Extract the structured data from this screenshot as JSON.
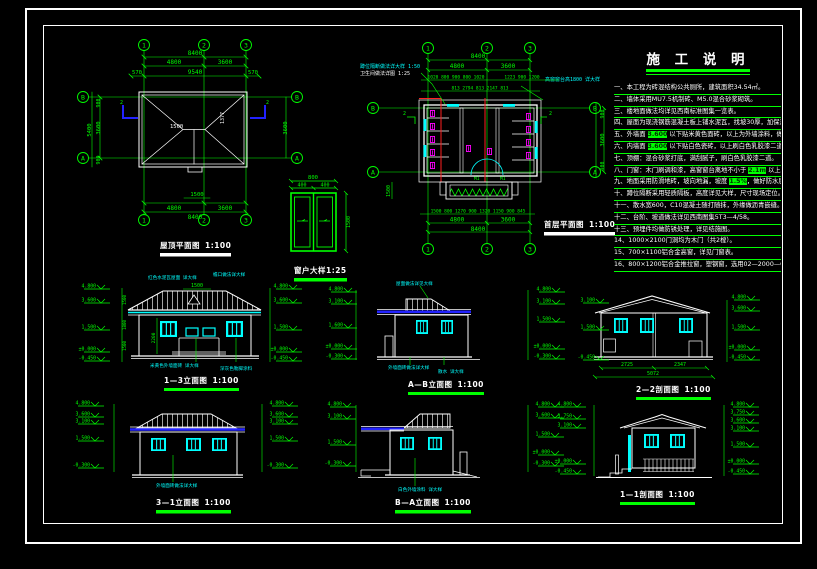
{
  "app": {
    "type": "architectural CAD sheet",
    "language": "zh-CN"
  },
  "colors": {
    "background": "#000000",
    "line_white": "#ffffff",
    "dim_green": "#00ff00",
    "window_cyan": "#00ffff",
    "fixture_magenta": "#ff00ff",
    "section_red": "#ff2020",
    "eave_blue": "#2222ff",
    "highlight_bg": "#00ff00"
  },
  "grid": {
    "c1": "1",
    "c2": "2",
    "c3": "3",
    "rB": "B",
    "rA": "A"
  },
  "roof_plan": {
    "title": "屋顶平面图",
    "scale": "1:100",
    "dim_total": "8400",
    "dim_seg1": "4800",
    "dim_seg2": "3600",
    "dim_oh_left": "570",
    "dim_oh_total": "9540",
    "dim_oh_right": "570",
    "dim_notch": "1500",
    "dim_left_total": "5400",
    "dim_left_seg": "3600",
    "dim_left_m1": "900",
    "dim_left_m2": "900",
    "dim_right_seg": "3600",
    "ridge_len": "1500",
    "slope_dim": "1377",
    "section_label": "2"
  },
  "window_detail": {
    "title": "窗户大样1:25",
    "dim_total": "800",
    "dim_half1": "400",
    "dim_half2": "400",
    "dim_height": "1500"
  },
  "floor_plan": {
    "title": "首层平面图",
    "scale": "1:100",
    "ann_left_1": "蹲位隔断做法详大样 1:50",
    "ann_left_2": "卫生间做法详图 1:25",
    "ann_right": "高窗窗台高1800 详大样",
    "dim_total": "8400",
    "dim_seg1": "4800",
    "dim_seg2": "3600",
    "dims_small_top_a": "1020 800 900 800 1020",
    "dims_small_top_b": "1223 900 1200",
    "dims_small_top2": "813 2794 813 2147 813",
    "dims_small_bottom": "1500 800 1270 900 1320 1150 900 845",
    "dim_side_total": "3600",
    "dim_side_m": "900",
    "porch_dim": "1500",
    "door_label": "M1",
    "section_label": "2"
  },
  "notes": {
    "title": "施 工 说 明",
    "lines": [
      {
        "pre": "一、本工程为砖混结构公共厕所，建筑面积34.54㎡。",
        "hl": "",
        "post": ""
      },
      {
        "pre": "二、墙体采用MU7.5机制砖、M5.0混合砂浆砌筑。",
        "hl": "",
        "post": ""
      },
      {
        "pre": "三、楼地面做法均详见西南标准图集一览表。",
        "hl": "",
        "post": ""
      },
      {
        "pre": "四、屋面为现浇钢筋混凝土板上铺水泥瓦，找坡30厚，加保温层。",
        "hl": "",
        "post": ""
      },
      {
        "pre": "五、外墙面 ",
        "hl": "3.600",
        "post": " 以下贴米黄色面砖，以上为外墙涂料，做法详见材料做法表。"
      },
      {
        "pre": "六、内墙面 ",
        "hl": "3.600",
        "post": " 以下贴白色瓷砖，以上刷白色乳胶漆二道，阳角做护角。"
      },
      {
        "pre": "七、顶棚：混合砂浆打底，满刮腻子，刷白色乳胶漆二道。",
        "hl": "",
        "post": ""
      },
      {
        "pre": "八、门窗：木门刷调和漆，高窗窗台离地不小于 ",
        "hl": "2.1m",
        "post": " 以上。"
      },
      {
        "pre": "九、地面采用防滑地砖，坡向地漏，坡度 ",
        "hl": "1.5%",
        "post": "，做好防水层。"
      },
      {
        "pre": "十、蹲位隔断采用轻质隔板，高度详见大样，尺寸现场定位。",
        "hl": "",
        "post": ""
      },
      {
        "pre": "十一、散水宽600，C10混凝土随打随抹，外缘做沥青嵌缝。",
        "hl": "",
        "post": ""
      },
      {
        "pre": "十二、台阶、坡道做法详见西南图集5T3—4/58。",
        "hl": "",
        "post": ""
      },
      {
        "pre": "十三、预埋件均做防锈处理，详见结施图。",
        "hl": "",
        "post": ""
      },
      {
        "pre": "14、1000×2100门洞均为木门（共2樘）。",
        "hl": "",
        "post": ""
      },
      {
        "pre": "15、700×1100铝合金高窗，详见门窗表。",
        "hl": "",
        "post": ""
      },
      {
        "pre": "16、800×1200铝合金推拉窗，塑钢窗，选用02—2000—CST—21。",
        "hl": "",
        "post": ""
      }
    ]
  },
  "elevations": {
    "e13": {
      "title": "1—3立面图",
      "scale": "1:100",
      "ridge_dim": "1500",
      "center_dim": "2200",
      "chain": [
        "1500",
        "1800",
        "1500"
      ],
      "levels_left": [
        "4.800",
        "3.600",
        "1.500",
        "±0.000",
        "-0.450"
      ],
      "levels_right": [
        "4.800",
        "3.600",
        "1.500",
        "±0.000",
        "-0.450"
      ],
      "ann_top1": "红色水泥瓦屋面 详大样",
      "ann_top2": "檐口做法详大样",
      "ann_bot1": "米黄色外墙面砖 详大样",
      "ann_bot2": "深灰色勒脚涂料"
    },
    "eAB": {
      "title": "A—B立面图",
      "scale": "1:100",
      "levels_left": [
        "4.800",
        "3.100",
        "1.600",
        "±0.000",
        "-0.300"
      ],
      "levels_right": [
        "4.800",
        "3.100",
        "1.500",
        "±0.000",
        "-0.300"
      ],
      "ann_top": "屋面做法详见大样",
      "ann_bot1": "外墙面砖做法详大样",
      "ann_bot2": "散水 详大样"
    },
    "e22": {
      "title": "2—2剖面图",
      "scale": "1:100",
      "dim_a": "2725",
      "dim_b": "2347",
      "dim_total": "5072",
      "levels_left": [
        "3.100",
        "1.500",
        "-0.450"
      ],
      "levels_right": [
        "4.800",
        "3.600",
        "1.500",
        "±0.000",
        "-0.450"
      ]
    },
    "e31": {
      "title": "3—1立面图",
      "scale": "1:100",
      "levels_left": [
        "4.800",
        "3.600",
        "3.100",
        "1.500",
        "-0.300"
      ],
      "levels_right": [
        "4.800",
        "3.600",
        "3.100",
        "1.500",
        "-0.300"
      ],
      "ann_bot": "外墙面砖做法详大样"
    },
    "eBA": {
      "title": "B—A立面图",
      "scale": "1:100",
      "levels_left": [
        "4.800",
        "3.100",
        "1.500",
        "-0.300"
      ],
      "levels_right": [
        "4.800",
        "3.600",
        "1.500",
        "±0.000",
        "-0.300"
      ],
      "ann_bot": "白色外墙涂料 详大样"
    },
    "e11": {
      "title": "1—1剖面图",
      "scale": "1:100",
      "levels_left": [
        "4.800",
        "3.750",
        "3.100",
        "±0.000",
        "-0.450"
      ],
      "levels_right": [
        "4.800",
        "3.750",
        "3.600",
        "3.100",
        "1.500",
        "±0.000",
        "-0.450"
      ]
    }
  }
}
